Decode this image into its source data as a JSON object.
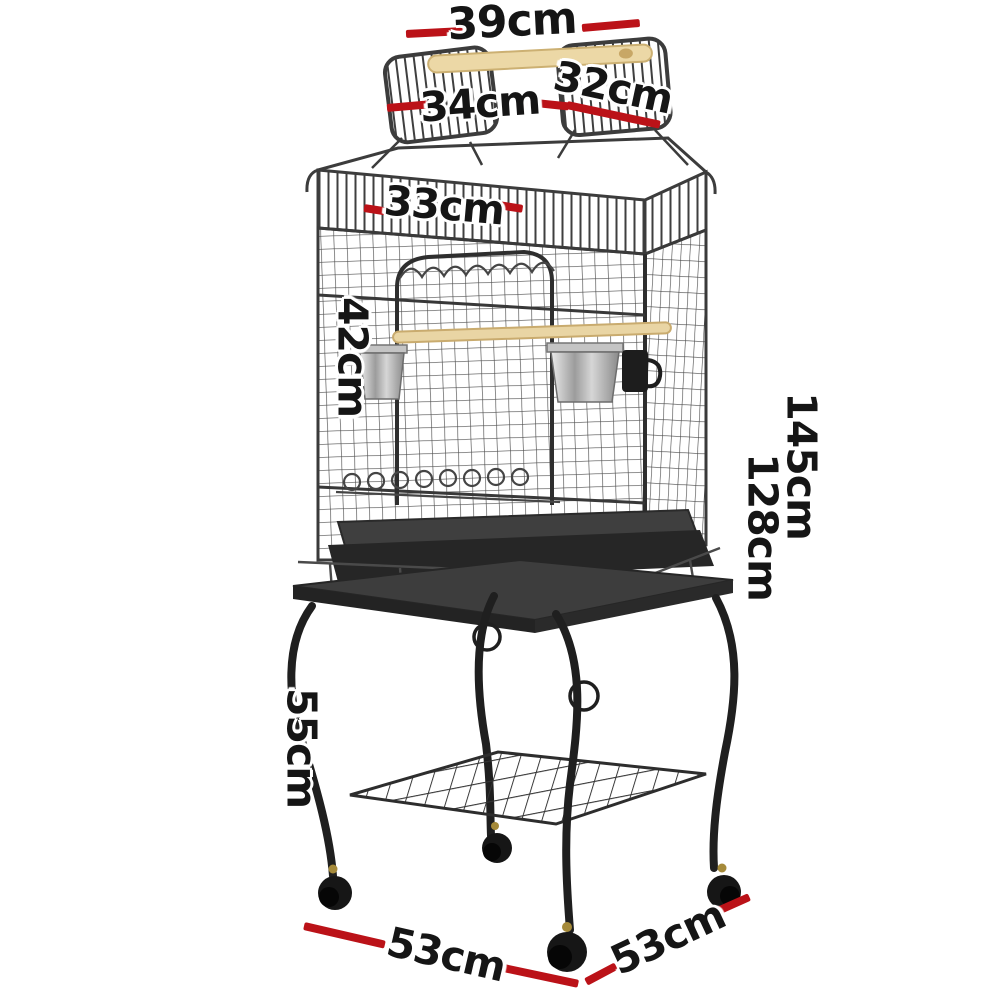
{
  "image_type": "product-dimension-diagram",
  "product": {
    "name": "Open-top bird cage with perch handle, feeder bowls and rolling castor stand"
  },
  "units": "cm",
  "colors": {
    "dimension_line": "#bb1218",
    "label_text": "#151515",
    "background": "#ffffff",
    "wood_perch": "#ecd8a6",
    "wire_metal": "#4f4f4f",
    "stand_metal": "#1f1f1f"
  },
  "dimensions": {
    "handle_width": {
      "label": "39cm",
      "part": "top handle / perch width"
    },
    "roof_panel_right": {
      "label": "32cm",
      "part": "right flip-open roof panel"
    },
    "roof_panel_left": {
      "label": "34cm",
      "part": "left flip-open roof panel"
    },
    "door_width": {
      "label": "33cm",
      "part": "front door width"
    },
    "door_height": {
      "label": "42cm",
      "part": "front door height"
    },
    "total_height": {
      "label": "145cm",
      "part": "total height with stand"
    },
    "cage_height": {
      "label": "128cm",
      "part": "height to cage top"
    },
    "stand_height": {
      "label": "55cm",
      "part": "stand leg height"
    },
    "base_width": {
      "label": "53cm",
      "part": "base width (front-left)"
    },
    "base_depth": {
      "label": "53cm",
      "part": "base depth (front-right)"
    }
  }
}
